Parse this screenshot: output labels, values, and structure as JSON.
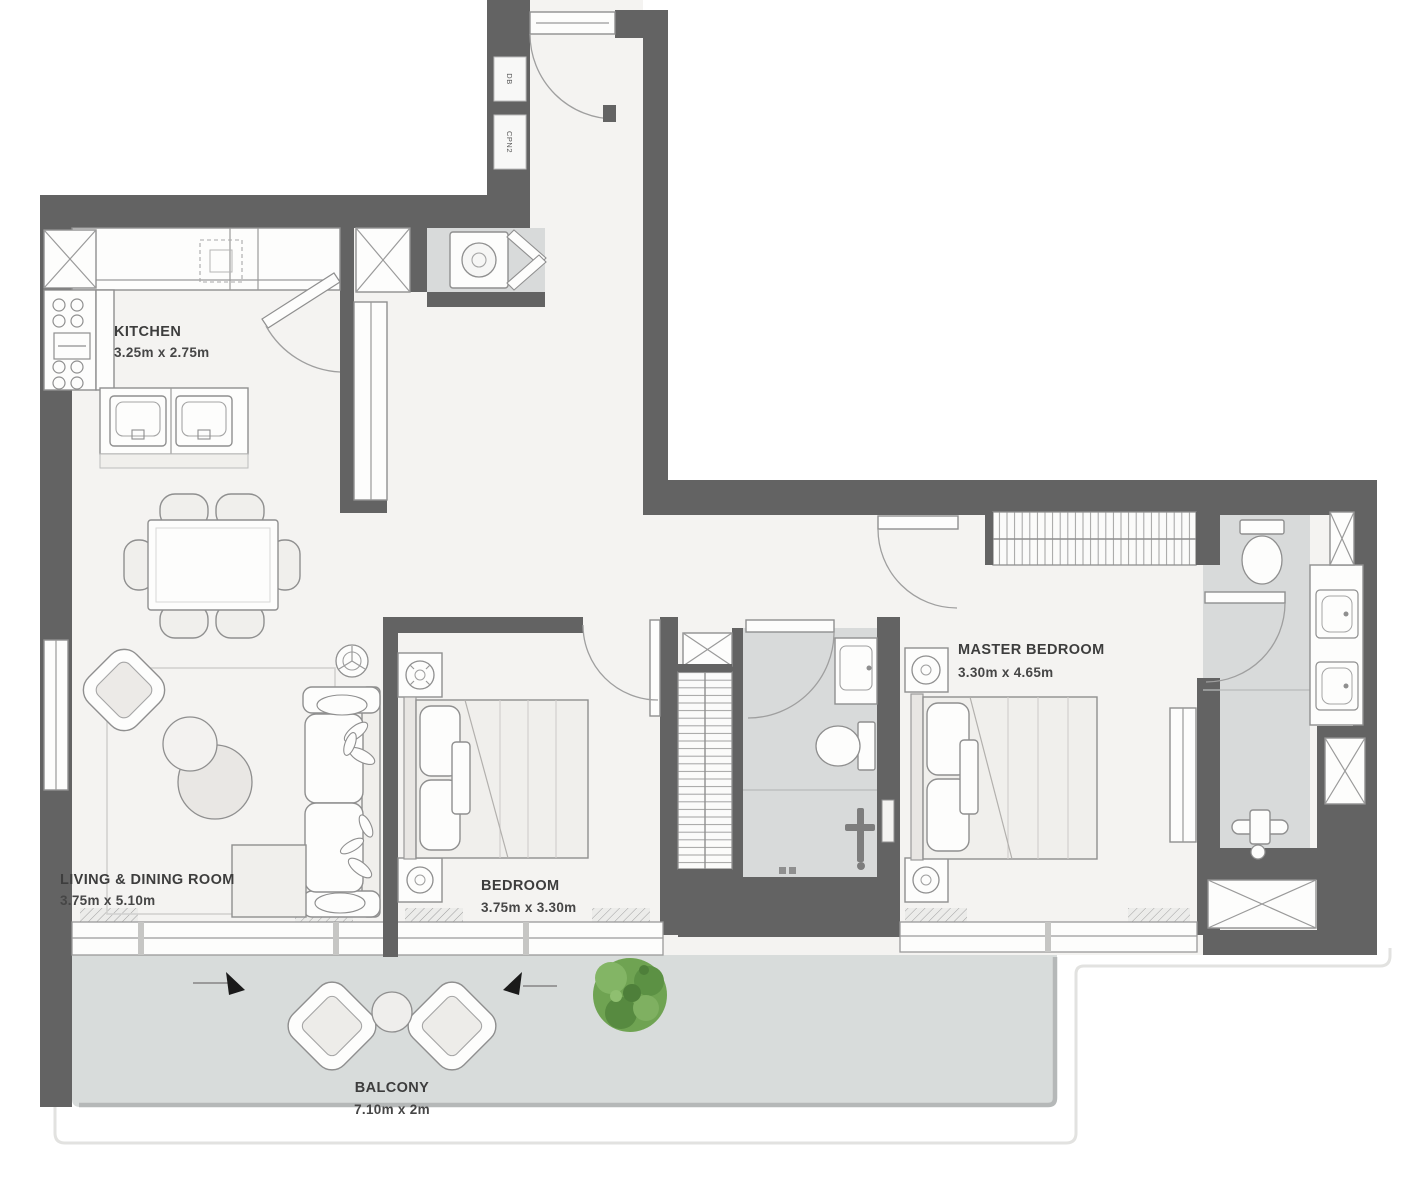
{
  "plan": {
    "title": "2-bedroom apartment floor plan",
    "rooms": {
      "kitchen": {
        "name": "KITCHEN",
        "dims": "3.25m x 2.75m"
      },
      "living": {
        "name": "LIVING & DINING ROOM",
        "dims": "3.75m x 5.10m"
      },
      "bedroom": {
        "name": "BEDROOM",
        "dims": "3.75m x 3.30m"
      },
      "master": {
        "name": "MASTER BEDROOM",
        "dims": "3.30m x 4.65m"
      },
      "balcony": {
        "name": "BALCONY",
        "dims": "7.10m x 2m"
      }
    },
    "utility_labels": {
      "db": "DB",
      "cpn": "CPN2"
    },
    "colors": {
      "wall": "#636363",
      "room_floor": "#f4f3f1",
      "wet_floor": "#d8dada",
      "balcony_floor": "#d8dcdb",
      "furniture_outline": "#8f8f8f",
      "tree_green": "#6fa352",
      "label_text": "#3d3d3d",
      "arrow_black": "#1a1a1a"
    }
  }
}
